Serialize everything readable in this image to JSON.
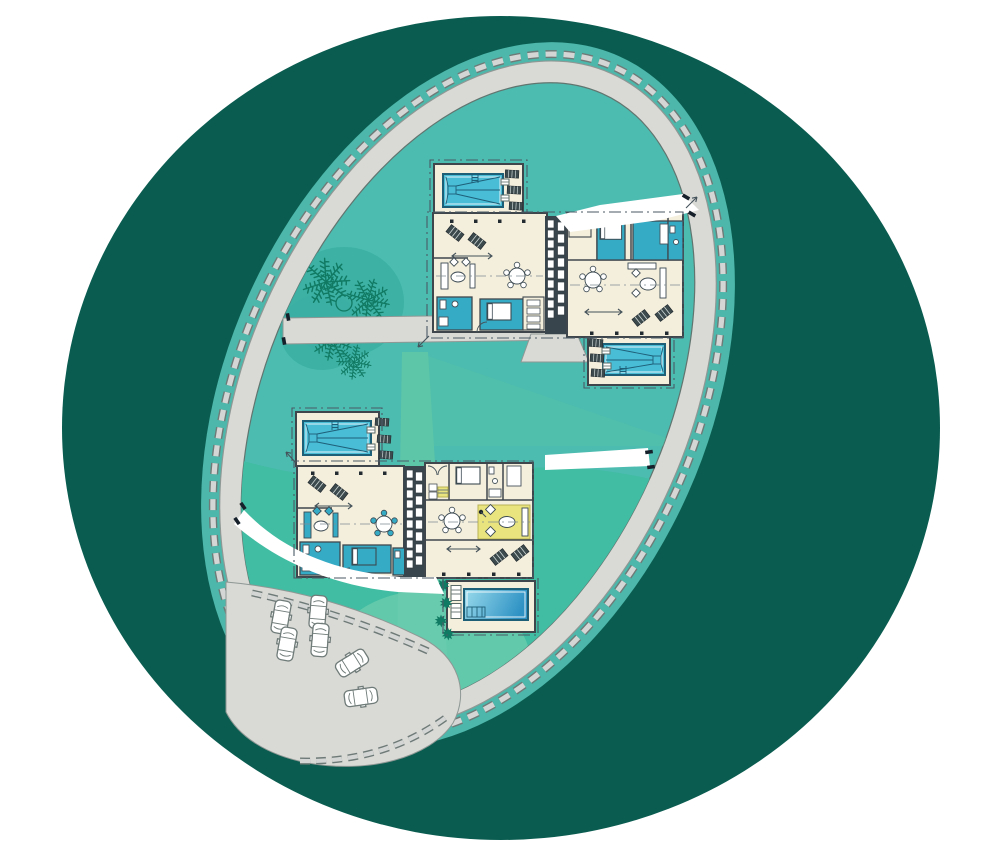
{
  "title": "Oval resort site plan with four pool villas, ring promenade, palm garden and parking court",
  "canvas": {
    "width": 999,
    "height": 842
  },
  "palette": {
    "outer": "#0a5c50",
    "margin": "#4cb7aa",
    "stone_dark": "#6e7a77",
    "stone_light": "#d3d6d4",
    "path": "#d9d9d6",
    "path_edge": "#8e9894",
    "inner": "#4cbcb0",
    "inner_edge": "#61756f",
    "inner_south": "#40bda2",
    "lawn": "#5ec6a8",
    "lawn2": "#6accae",
    "lawn_wedge": "#53c1a7",
    "floor": "#f4eedc",
    "wall": "#3f474d",
    "room": "#35abc6",
    "pool": "#49bcd6",
    "pool_line": "#1e5f78",
    "pool_g1": "#9adbec",
    "pool_g2": "#2e92c4",
    "rug": "#e9e47e",
    "tree": "#117a63",
    "tree_blob": "#3bafa3",
    "lounger": "#3c4a4e",
    "boundary": "#4a5a66",
    "white": "#ffffff"
  },
  "scene": {
    "site": {
      "shape": "tilted oval enclosed by stone-edged ring promenade",
      "rotation_deg": 24
    },
    "complexes": [
      {
        "name": "north-twin-villa",
        "villas": 2,
        "pools": 2,
        "sun_loungers": 10,
        "dining_tables": 2,
        "teal_rooms": 6
      },
      {
        "name": "south-twin-villa",
        "villas": 2,
        "pools": 2,
        "sun_loungers": 9,
        "dining_tables": 2,
        "teal_rooms": 5,
        "yellow_rug": true
      }
    ],
    "parking": {
      "cars": 6
    },
    "vegetation": {
      "palm_clusters": 4,
      "pine_trees": 2,
      "shrubs": 4
    },
    "paths": {
      "white_paths": 3,
      "gray_paths": 2,
      "gates": 4
    }
  }
}
